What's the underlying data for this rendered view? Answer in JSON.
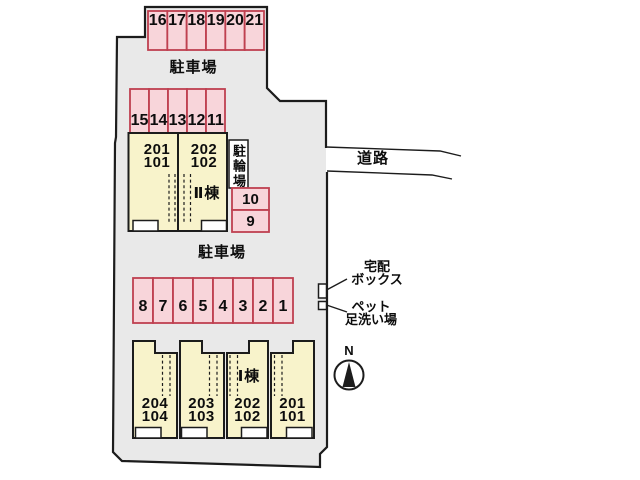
{
  "map": {
    "area_labels": {
      "parking_top": "駐車場",
      "parking_middle": "駐車場",
      "road": "道路",
      "bicycle_parking": "駐輪場"
    },
    "parking": {
      "top_row": [
        "16",
        "17",
        "18",
        "19",
        "20",
        "21"
      ],
      "second_row": [
        "15",
        "14",
        "13",
        "12",
        "11"
      ],
      "middle_row": [
        "8",
        "7",
        "6",
        "5",
        "4",
        "3",
        "2",
        "1"
      ],
      "side_column": [
        "10",
        "9"
      ]
    },
    "buildings": {
      "building_2": {
        "name": "Ⅱ棟",
        "units": [
          {
            "upper": "201",
            "lower": "101"
          },
          {
            "upper": "202",
            "lower": "102"
          }
        ]
      },
      "building_1": {
        "name": "Ⅰ棟",
        "units": [
          {
            "upper": "204",
            "lower": "104"
          },
          {
            "upper": "203",
            "lower": "103"
          },
          {
            "upper": "202",
            "lower": "102"
          },
          {
            "upper": "201",
            "lower": "101"
          }
        ]
      }
    },
    "annotations": {
      "delivery_box": [
        "宅配",
        "ボックス"
      ],
      "pet_wash": [
        "ペット",
        "足洗い場"
      ],
      "compass_north": "N"
    },
    "colors": {
      "site_fill": "#e9e9e9",
      "parking_fill": "#f8d5da",
      "parking_border": "#bf4050",
      "building_fill": "#f8f3cb",
      "outline": "#1c1c1c"
    }
  }
}
